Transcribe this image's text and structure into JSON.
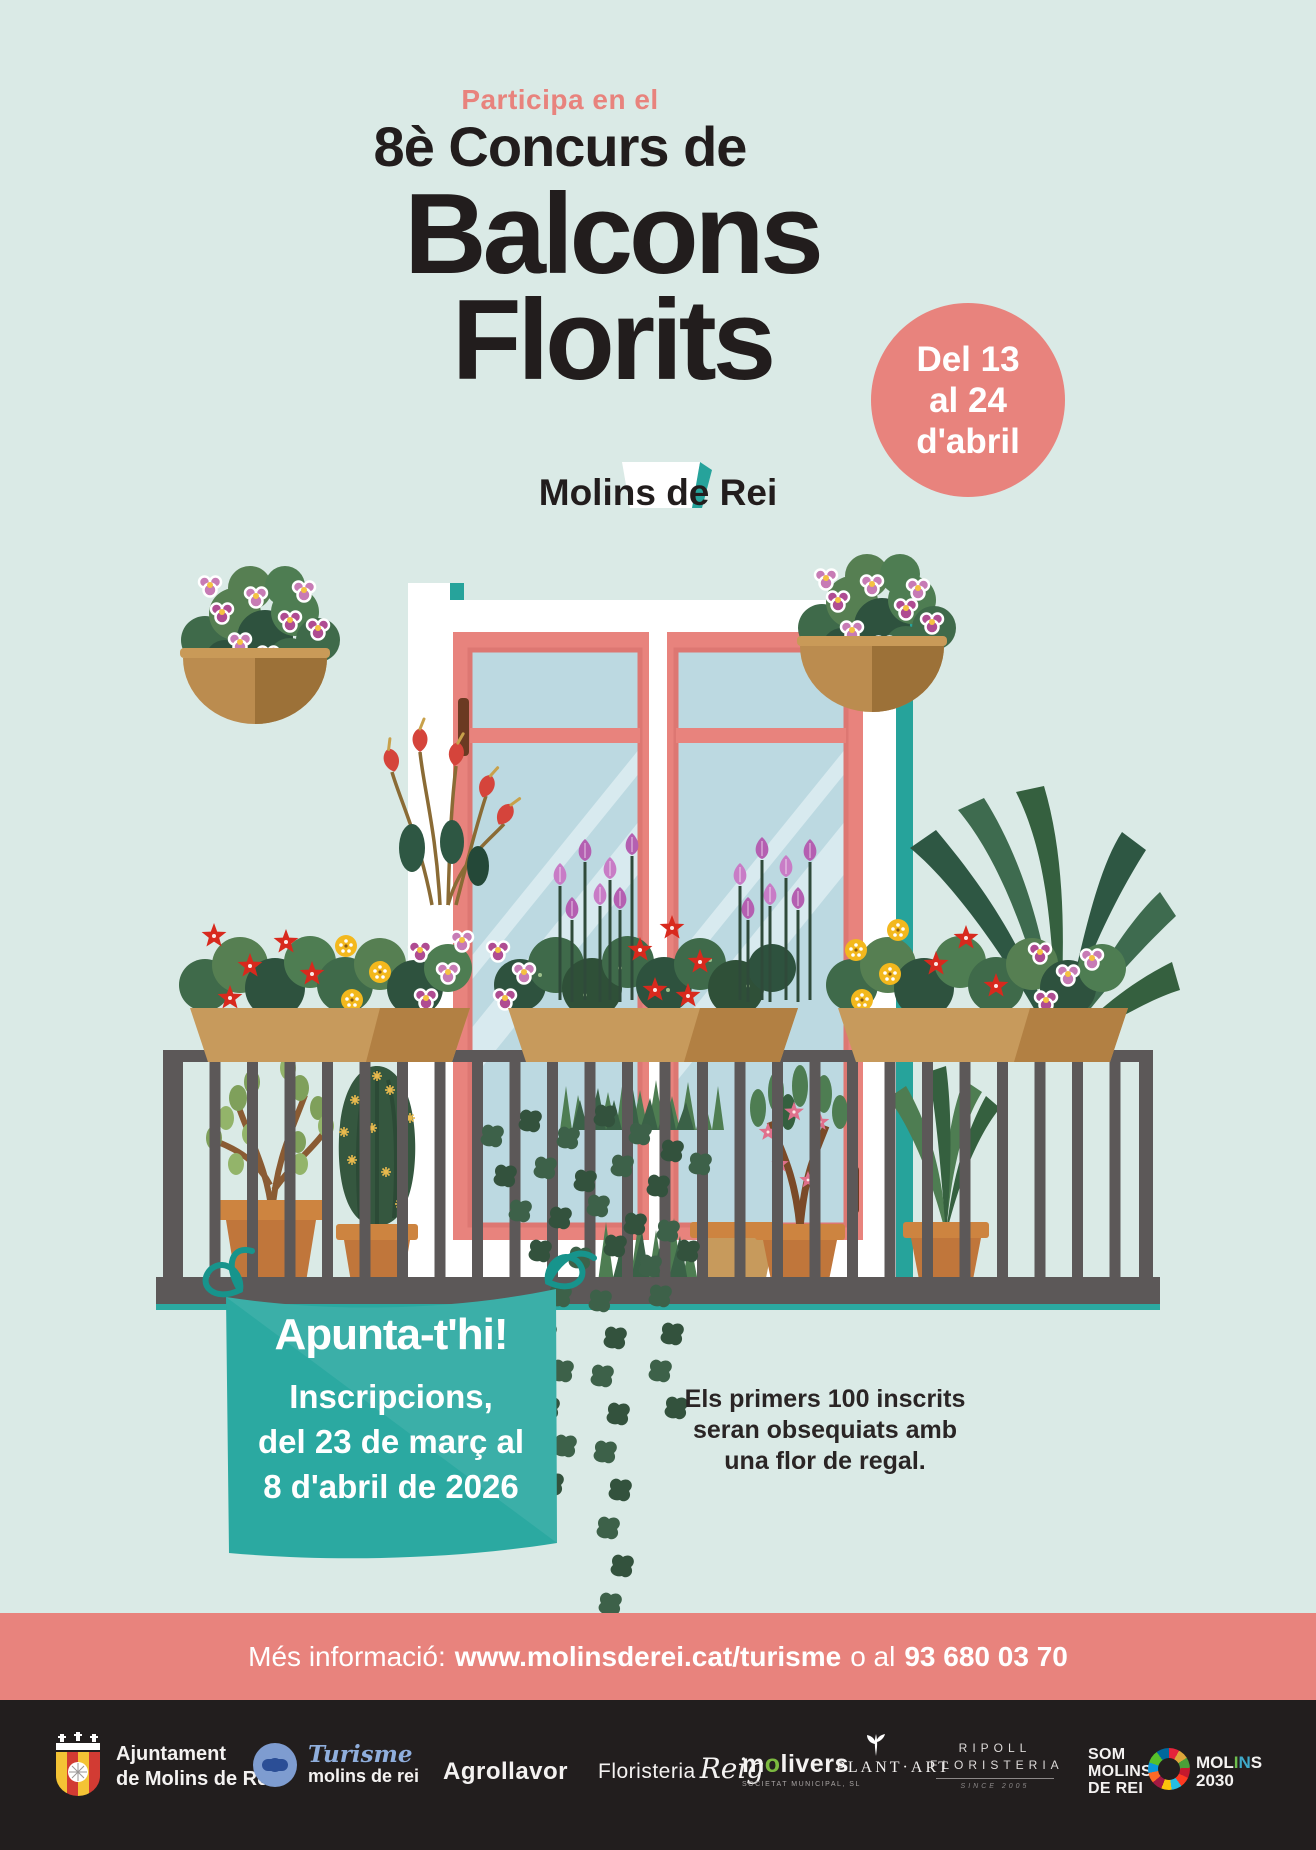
{
  "header": {
    "kicker": "Participa en el",
    "title_line": "8è Concurs de",
    "big_line1": "Balcons",
    "big_line2": "Florits",
    "subtitle": "Molins de Rei"
  },
  "badge": {
    "line1": "Del 13",
    "line2": "al 24",
    "line3": "d'abril"
  },
  "banner": {
    "title": "Apunta-t'hi!",
    "line1": "Inscripcions,",
    "line2": "del 23 de març al",
    "line3": "8 d'abril de 2026"
  },
  "note": {
    "line1": "Els primers 100 inscrits",
    "line2": "seran obsequiats amb",
    "line3": "una flor de regal."
  },
  "infobar": {
    "prefix": "Més informació:",
    "url": "www.molinsderei.cat/turisme",
    "middle": "o al",
    "phone": "93 680 03 70"
  },
  "footer": {
    "ajuntament": {
      "line1": "Ajuntament",
      "line2": "de Molins de Rei"
    },
    "turisme": {
      "script": "Turisme",
      "label": "molins de rei"
    },
    "agrollavor": "Agrollavor",
    "floristeria": {
      "name": "Floristeria",
      "script": "Reig"
    },
    "molivers": {
      "m": "m",
      "o": "o",
      "rest": "livers",
      "sub": "SOCIETAT MUNICIPAL, SL"
    },
    "plantart": "PLANT·ART",
    "ripoll": {
      "line1": "RIPOLL",
      "line2": "FLORISTERIA",
      "sub": "SINCE 2005"
    },
    "som": {
      "line1": "SOM",
      "line2": "MOLINS",
      "line3": "DE REI"
    },
    "molins2030": {
      "p1": "MOL",
      "p2": "I",
      "p3": "N",
      "p4": "S",
      "line2": "2030"
    }
  },
  "colors": {
    "background_mint": "#DAEAE6",
    "accent_salmon": "#E8837D",
    "accent_teal": "#2BA9A1",
    "ink_black": "#221D1D",
    "footer_black": "#221E1E"
  }
}
